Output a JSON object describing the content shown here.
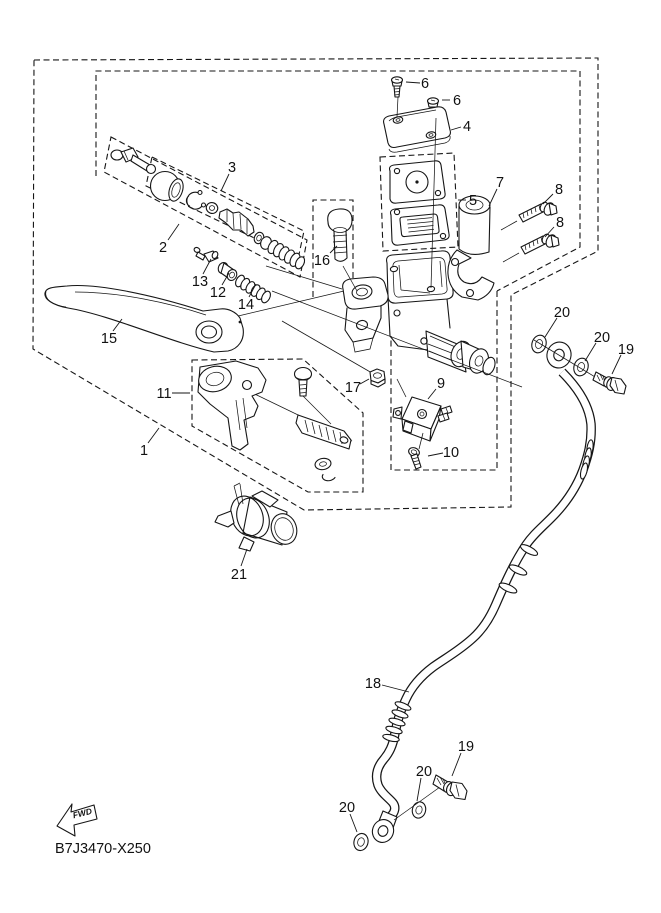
{
  "diagram": {
    "drawing_code": "B7J3470-X250",
    "fwd_label": "FWD",
    "background": "#ffffff",
    "line_color": "#161616"
  },
  "callouts": [
    {
      "n": "6",
      "x": 425,
      "y": 83,
      "l": [
        420,
        83,
        406,
        82
      ]
    },
    {
      "n": "6",
      "x": 457,
      "y": 100,
      "l": [
        450,
        100,
        442,
        100
      ]
    },
    {
      "n": "4",
      "x": 467,
      "y": 126,
      "l": [
        461,
        127,
        451,
        130
      ]
    },
    {
      "n": "5",
      "x": 473,
      "y": 200,
      "l": [
        466,
        200,
        458,
        200
      ]
    },
    {
      "n": "7",
      "x": 500,
      "y": 182,
      "l": [
        497,
        189,
        489,
        206
      ]
    },
    {
      "n": "8",
      "x": 559,
      "y": 189,
      "l": [
        553,
        194,
        543,
        204
      ]
    },
    {
      "n": "8",
      "x": 560,
      "y": 222,
      "l": [
        554,
        227,
        545,
        237
      ]
    },
    {
      "n": "3",
      "x": 232,
      "y": 167,
      "l": [
        229,
        174,
        221,
        191
      ]
    },
    {
      "n": "2",
      "x": 163,
      "y": 247,
      "l": [
        168,
        240,
        179,
        224
      ]
    },
    {
      "n": "13",
      "x": 200,
      "y": 281,
      "l": [
        203,
        274,
        211,
        259
      ]
    },
    {
      "n": "12",
      "x": 218,
      "y": 292,
      "l": [
        222,
        285,
        229,
        273
      ]
    },
    {
      "n": "14",
      "x": 246,
      "y": 304,
      "l": [
        249,
        297,
        256,
        284
      ]
    },
    {
      "n": "16",
      "x": 322,
      "y": 260,
      "l": [
        330,
        253,
        337,
        246
      ]
    },
    {
      "n": "15",
      "x": 109,
      "y": 338,
      "l": [
        113,
        331,
        122,
        319
      ]
    },
    {
      "n": "11",
      "x": 164,
      "y": 393,
      "l": [
        172,
        393,
        190,
        393
      ]
    },
    {
      "n": "1",
      "x": 144,
      "y": 450,
      "l": [
        148,
        443,
        159,
        428
      ]
    },
    {
      "n": "17",
      "x": 353,
      "y": 387,
      "l": [
        360,
        384,
        369,
        379
      ]
    },
    {
      "n": "9",
      "x": 441,
      "y": 383,
      "l": [
        436,
        389,
        428,
        399
      ]
    },
    {
      "n": "10",
      "x": 451,
      "y": 452,
      "l": [
        443,
        453,
        428,
        456
      ]
    },
    {
      "n": "20",
      "x": 562,
      "y": 312,
      "l": [
        557,
        318,
        545,
        337
      ]
    },
    {
      "n": "20",
      "x": 602,
      "y": 337,
      "l": [
        596,
        343,
        585,
        361
      ]
    },
    {
      "n": "19",
      "x": 626,
      "y": 349,
      "l": [
        621,
        355,
        612,
        374
      ]
    },
    {
      "n": "21",
      "x": 239,
      "y": 574,
      "l": [
        241,
        566,
        247,
        549
      ]
    },
    {
      "n": "18",
      "x": 373,
      "y": 683,
      "l": [
        382,
        685,
        409,
        692
      ]
    },
    {
      "n": "19",
      "x": 466,
      "y": 746,
      "l": [
        461,
        753,
        452,
        776
      ]
    },
    {
      "n": "20",
      "x": 424,
      "y": 771,
      "l": [
        421,
        778,
        417,
        801
      ]
    },
    {
      "n": "20",
      "x": 347,
      "y": 807,
      "l": [
        350,
        814,
        357,
        832
      ]
    }
  ]
}
